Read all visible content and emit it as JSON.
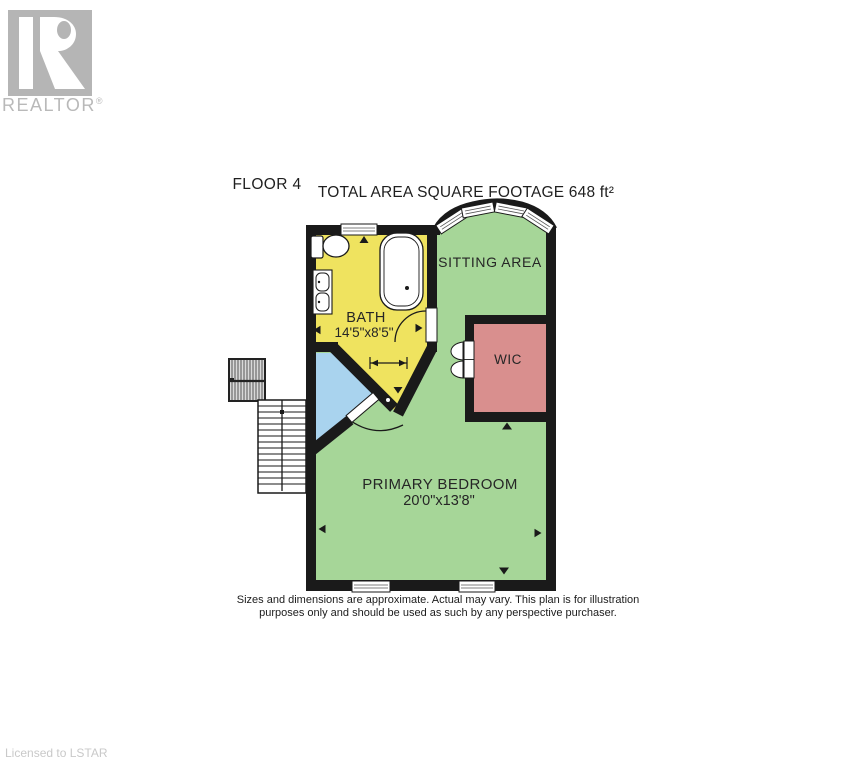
{
  "branding": {
    "realtor_label": "REALTOR",
    "registered_mark": "®",
    "licensed_label": "Licensed to LSTAR"
  },
  "header": {
    "floor_label": "FLOOR 4",
    "total_area_label": "TOTAL AREA SQUARE FOOTAGE 648  ft²"
  },
  "rooms": {
    "sitting_area": {
      "label": "SITTING AREA"
    },
    "bath": {
      "label": "BATH",
      "dims": "14'5\"x8'5\""
    },
    "wic": {
      "label": "WIC"
    },
    "primary_bedroom": {
      "label": "PRIMARY BEDROOM",
      "dims": "20'0\"x13'8\""
    }
  },
  "disclaimer": {
    "line1": "Sizes and dimensions are approximate. Actual may vary. This plan is for illustration",
    "line2": "purposes only and should be used as such by any perspective purchaser."
  },
  "colors": {
    "wall": "#1a1a1a",
    "room_green": "#A6D698",
    "room_yellow": "#EFE35F",
    "room_pink": "#D98F8E",
    "room_blue": "#A9D3EE",
    "logo_gray": "#B5B5B5",
    "muted_gray": "#C9C9C9"
  }
}
